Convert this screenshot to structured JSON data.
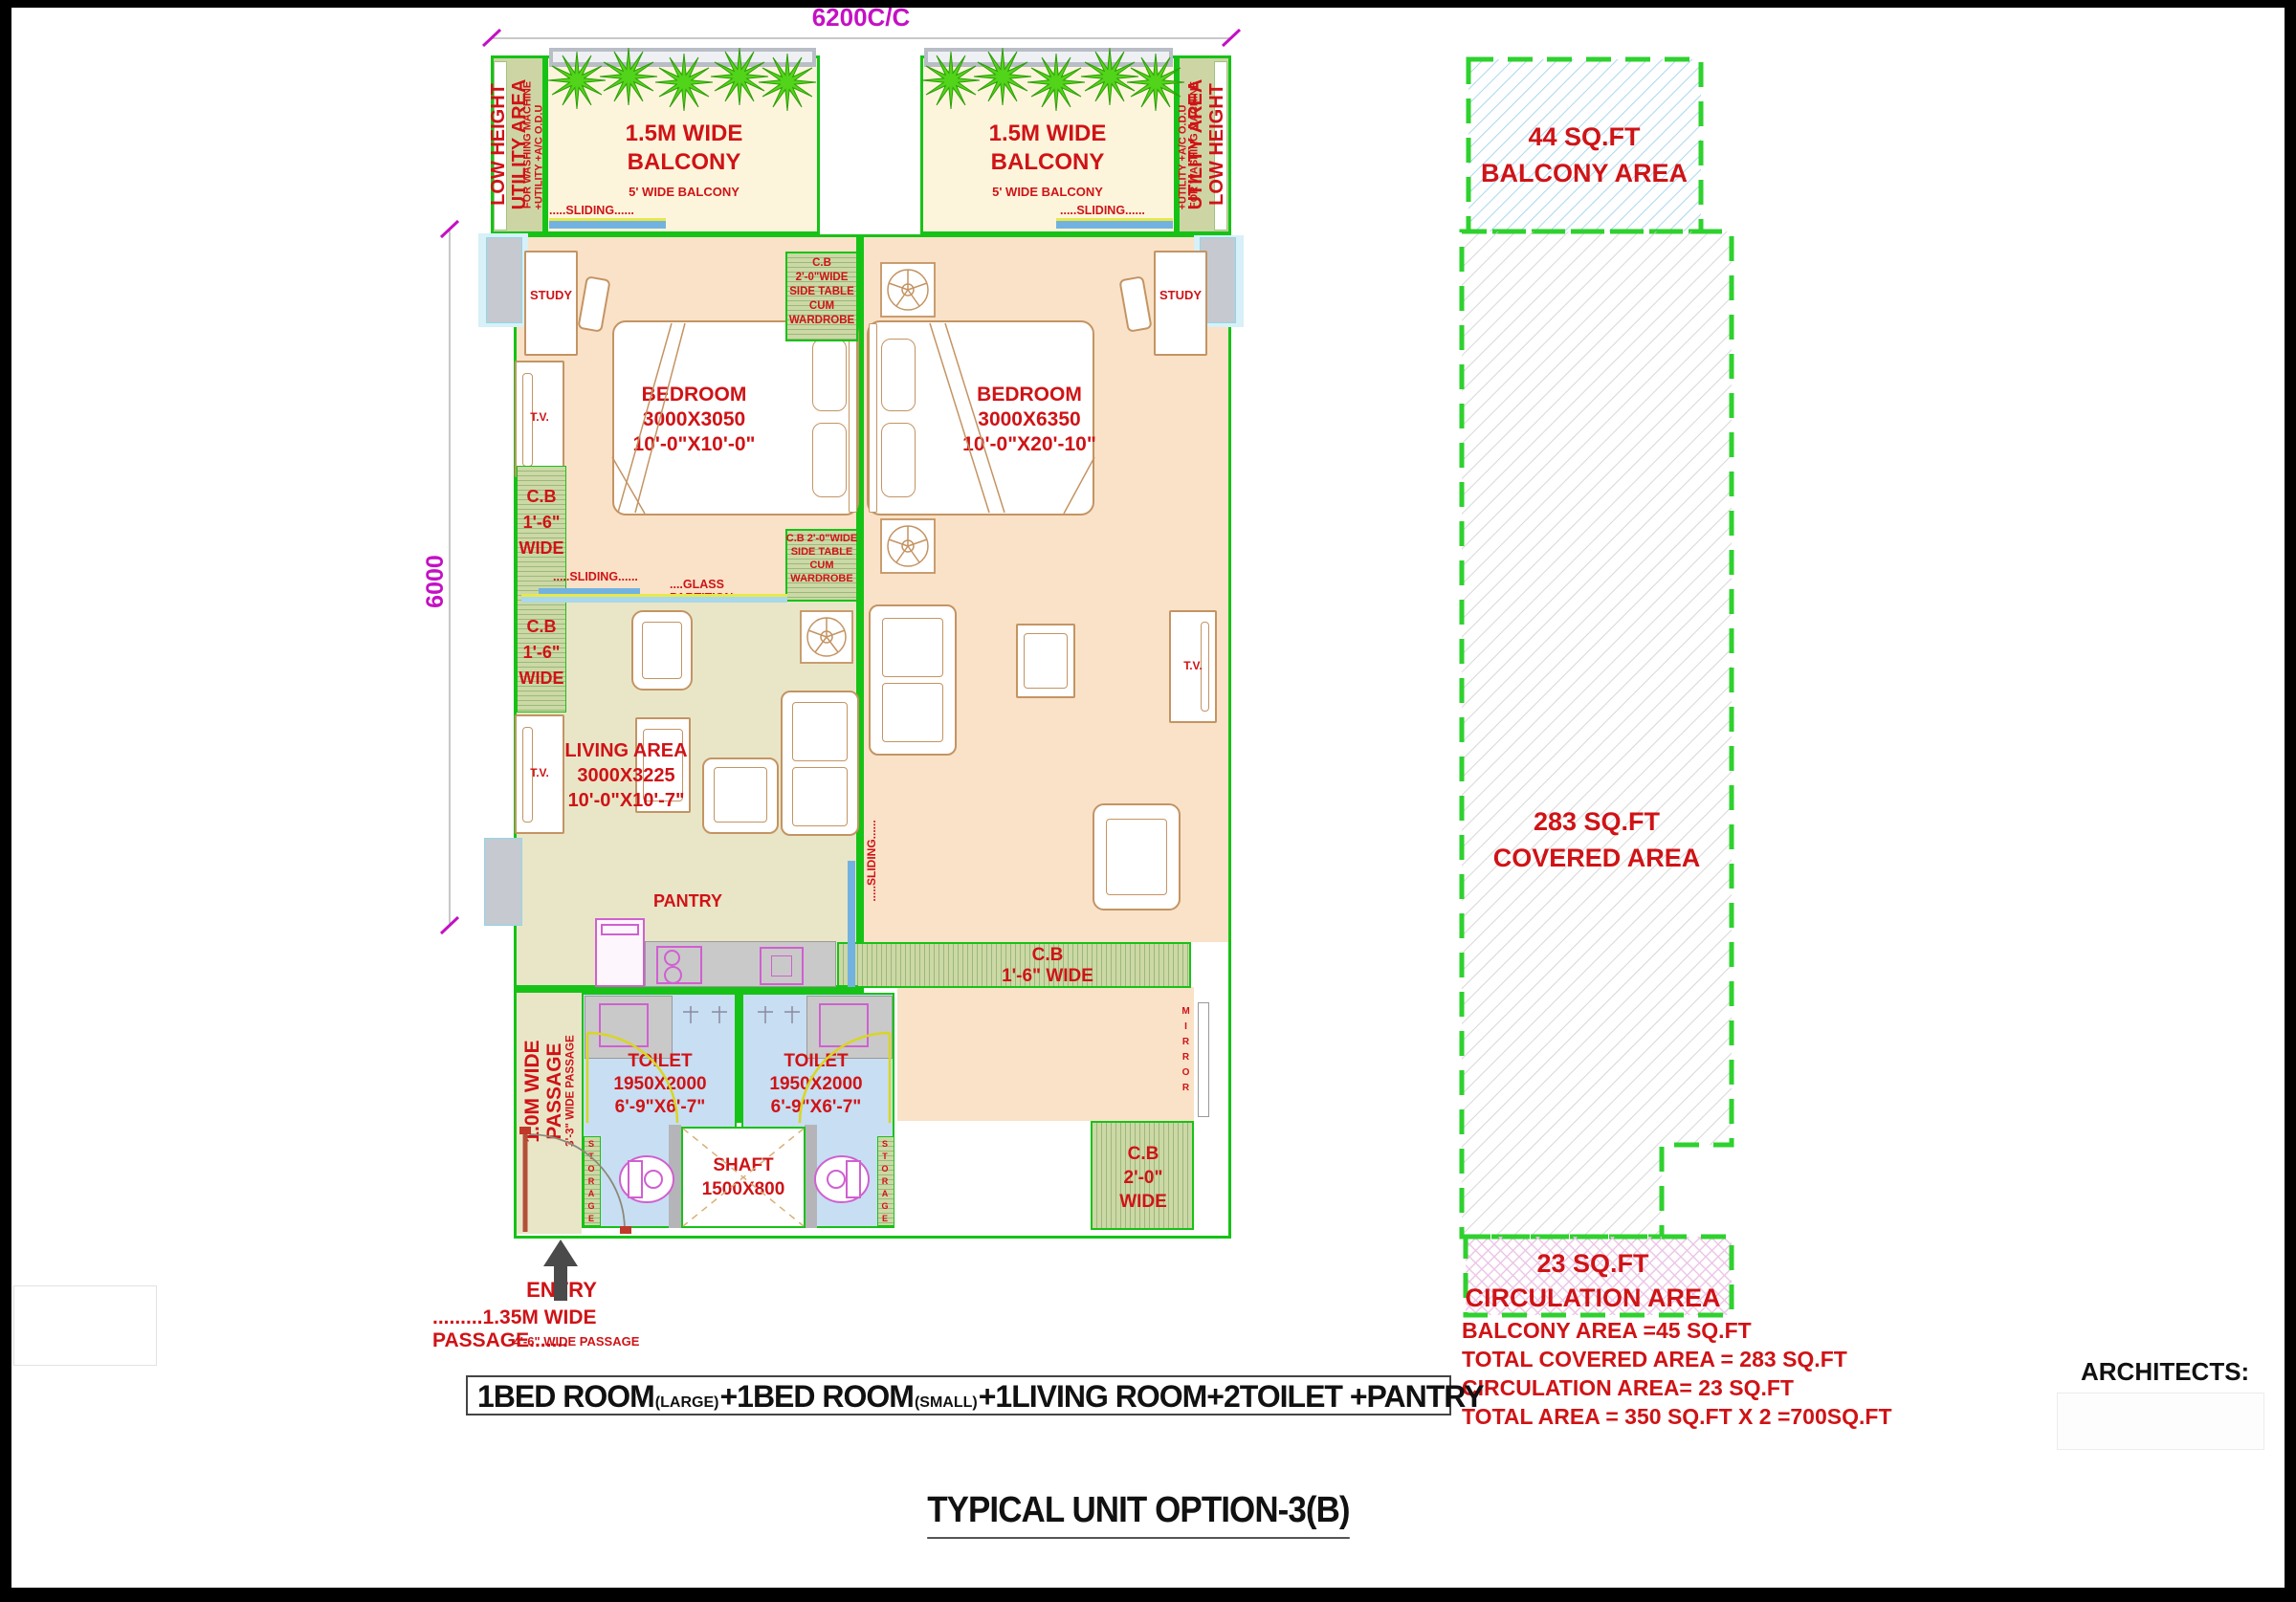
{
  "dim": {
    "top": "6200C/C",
    "side": "6000"
  },
  "utility": {
    "big1": "LOW HEIGHT",
    "big2": "UTILITY AREA",
    "small1": "FOR WASHING MACHINE",
    "small2": "+UTILITY +A/C O.D.U"
  },
  "balcony": {
    "line1": "1.5M WIDE",
    "line2": "BALCONY",
    "sub": "5' WIDE BALCONY",
    "sliding": ".....SLIDING......"
  },
  "bedroom1": {
    "title": "BEDROOM",
    "mm": "3000X3050",
    "ft": "10'-0\"X10'-0\""
  },
  "bedroom2": {
    "title": "BEDROOM",
    "mm": "3000X6350",
    "ft": "10'-0\"X20'-10\""
  },
  "study": "STUDY",
  "tv": "T.V.",
  "wardrobe": {
    "l1": "C.B 2'-0\"WIDE",
    "l2": "SIDE TABLE",
    "l3": "CUM",
    "l4": "WARDROBE"
  },
  "cb_vert": {
    "l1": "C.B",
    "l2": "1'-6\"",
    "l3": "WIDE"
  },
  "cb_horiz": {
    "l1": "C.B",
    "l2": "1'-6\" WIDE"
  },
  "cb_20": {
    "l1": "C.B",
    "l2": "2'-0\"",
    "l3": "WIDE"
  },
  "living": {
    "title": "LIVING AREA",
    "mm": "3000X3225",
    "ft": "10'-0\"X10'-7\""
  },
  "pantry": "PANTRY",
  "glass": "....GLASS PARTITION....",
  "sliding": ".....SLIDING......",
  "toilet": {
    "title": "TOILET",
    "mm": "1950X2000",
    "ft": "6'-9\"X6'-7\""
  },
  "shaft": {
    "title": "SHAFT",
    "mm": "1500X800"
  },
  "storage": "STORAGE",
  "mirror": "MIRROR",
  "passage": {
    "v1": "1.0M WIDE",
    "v2": "PASSAGE",
    "v3": "3'-3\" WIDE PASSAGE"
  },
  "entry": "ENTRY",
  "bottom": {
    "p1": ".........1.35M WIDE PASSAGE.......",
    "p2": "4'-6\" WIDE PASSAGE"
  },
  "program": {
    "seg1": "1BED ROOM",
    "sup1": "(LARGE)",
    "plus": "+",
    "seg2": "1BED ROOM",
    "sup2": "(SMALL)",
    "rest": "+1LIVING ROOM+2TOILET +PANTRY"
  },
  "title": "TYPICAL UNIT OPTION-3(B)",
  "areas": {
    "balcony": {
      "l1": "44 SQ.FT",
      "l2": "BALCONY AREA"
    },
    "covered": {
      "l1": "283 SQ.FT",
      "l2": "COVERED AREA"
    },
    "circulation": {
      "l1": "23 SQ.FT",
      "l2": "CIRCULATION AREA"
    },
    "summary": [
      "BALCONY AREA =45 SQ.FT",
      "TOTAL COVERED AREA = 283 SQ.FT",
      "CIRCULATION AREA= 23 SQ.FT",
      "TOTAL AREA = 350 SQ.FT X 2 =700SQ.FT"
    ]
  },
  "architects": "ARCHITECTS:",
  "colors": {
    "wall_green": "#17c217",
    "label_red": "#cf1316",
    "dim_magenta": "#c410c4",
    "bedroom_peach": "#f9e2c8",
    "living_khaki": "#e9e6c8",
    "balcony_cream": "#fcf5dc",
    "utility_olive": "#cdd5a5",
    "toilet_blue": "#c8def2",
    "sliding_blue": "#72b2e0",
    "plant_green": "#52d41a",
    "furniture_tan": "#c49463"
  }
}
